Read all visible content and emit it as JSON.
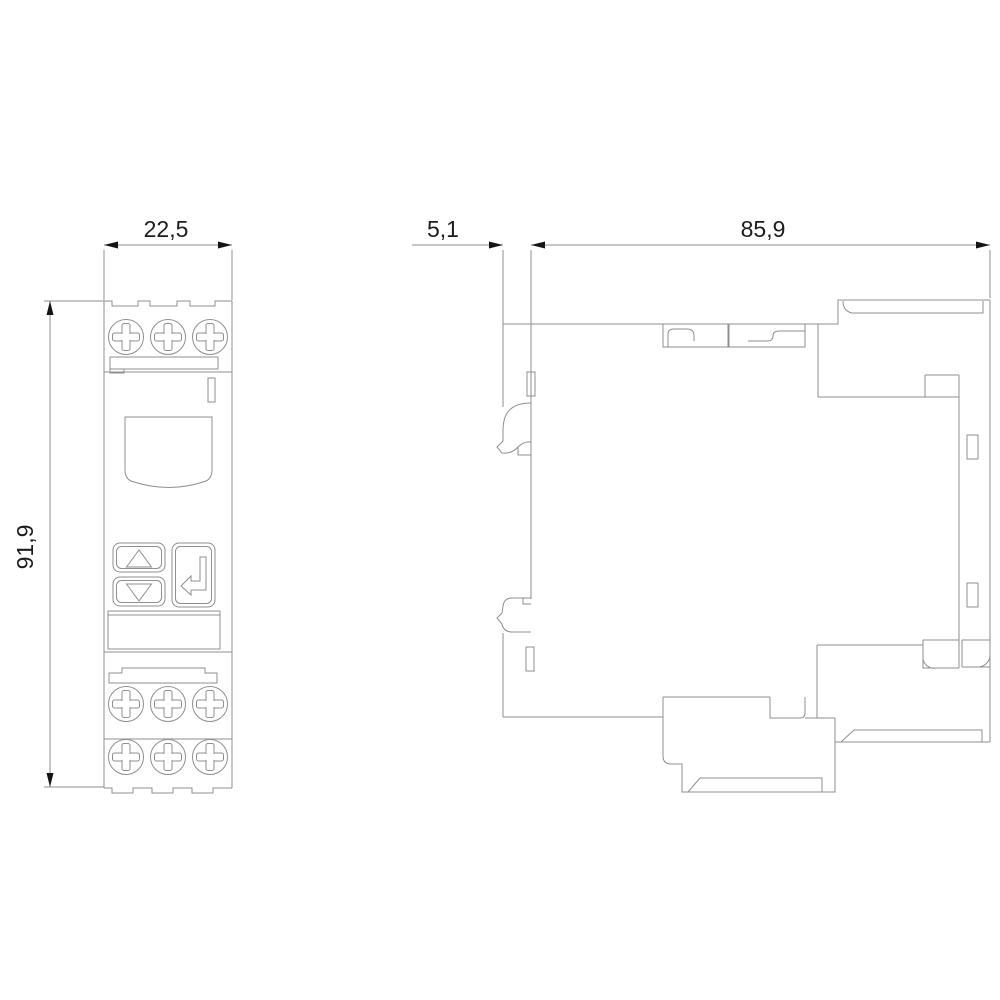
{
  "dimensions": {
    "front_width_mm": "22,5",
    "front_height_mm": "91,9",
    "side_rail_offset_mm": "5,1",
    "side_depth_mm": "85,9"
  },
  "colors": {
    "line": "#8f8f8f",
    "dim_text": "#1c1c1c",
    "arrow": "#141414",
    "background": "#ffffff"
  }
}
